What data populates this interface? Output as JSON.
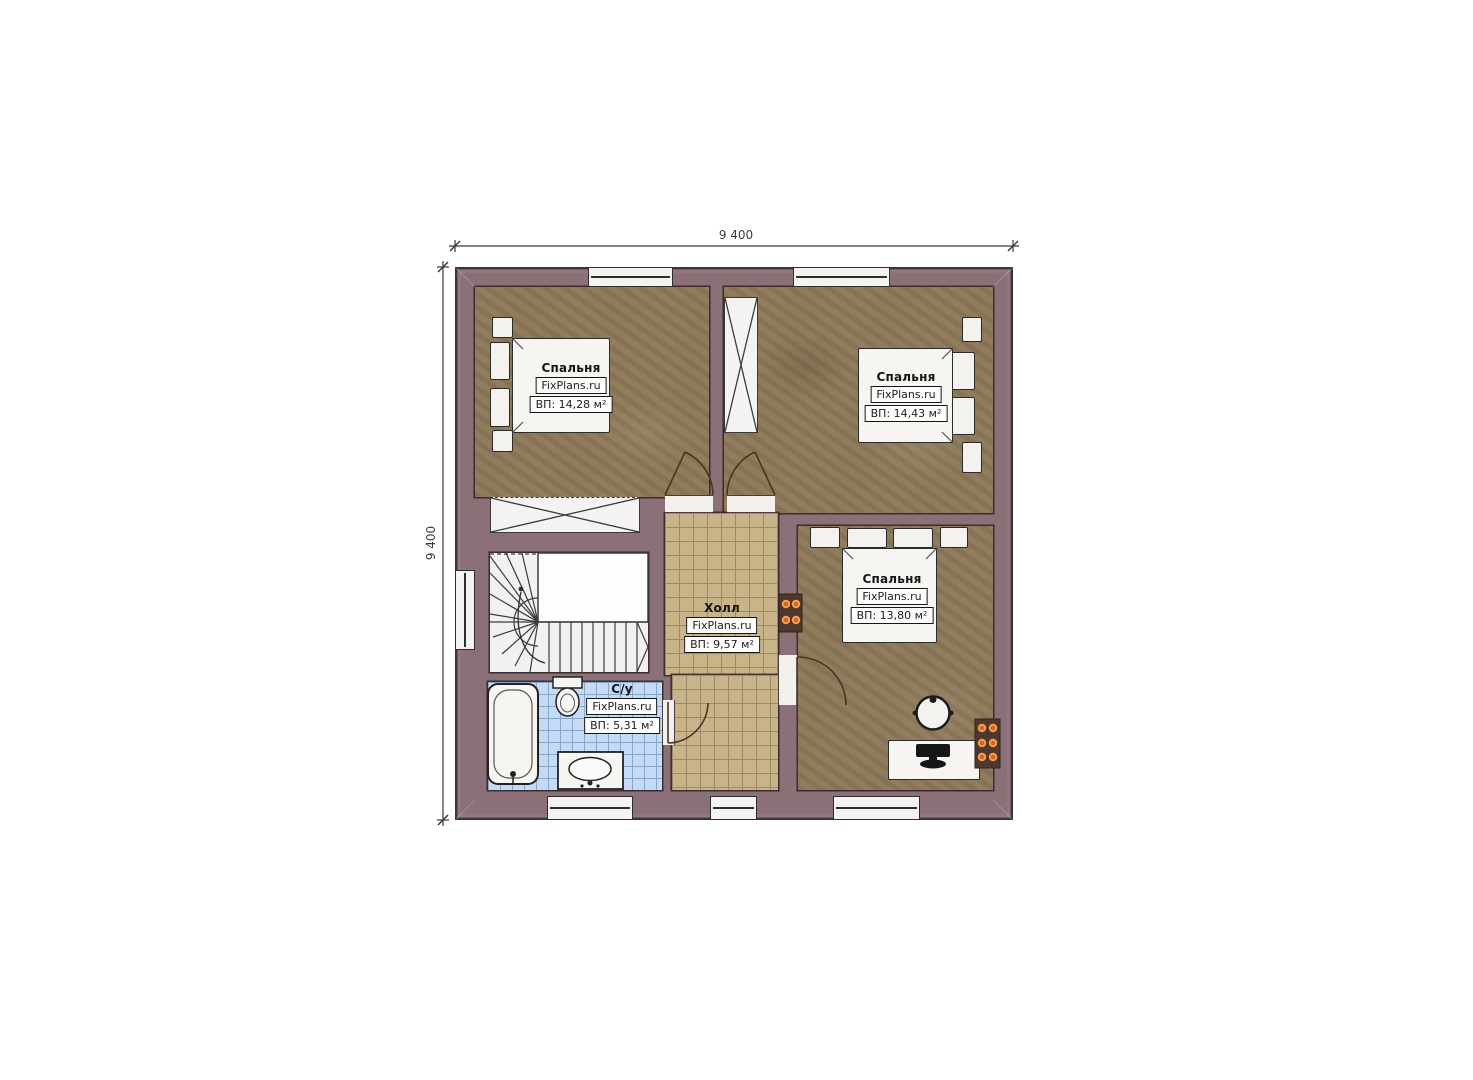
{
  "plan": {
    "type": "floor-plan",
    "floor_note": "second floor plan with three bedrooms, hall, bathroom and winder stair"
  },
  "dimensions": {
    "top": "9 400",
    "left": "9 400"
  },
  "rooms": {
    "bedroom_tl": {
      "name": "Спальня",
      "brand": "FixPlans.ru",
      "area": "ВП: 14,28 м²"
    },
    "bedroom_tr": {
      "name": "Спальня",
      "brand": "FixPlans.ru",
      "area": "ВП: 14,43 м²"
    },
    "bedroom_br": {
      "name": "Спальня",
      "brand": "FixPlans.ru",
      "area": "ВП: 13,80 м²"
    },
    "hall": {
      "name": "Холл",
      "brand": "FixPlans.ru",
      "area": "ВП: 9,57 м²"
    },
    "bathroom": {
      "name": "С/у",
      "brand": "FixPlans.ru",
      "area": "ВП: 5,31 м²"
    }
  },
  "colors": {
    "wall": "#8b7077",
    "wall_outline": "#41323a",
    "bedroom_floor": "#8d7958",
    "hall_floor": "#c9b489",
    "bath_floor": "#c5dbf3",
    "stairs": "#f2f1ef",
    "radiator_glow": "#e8681c"
  }
}
